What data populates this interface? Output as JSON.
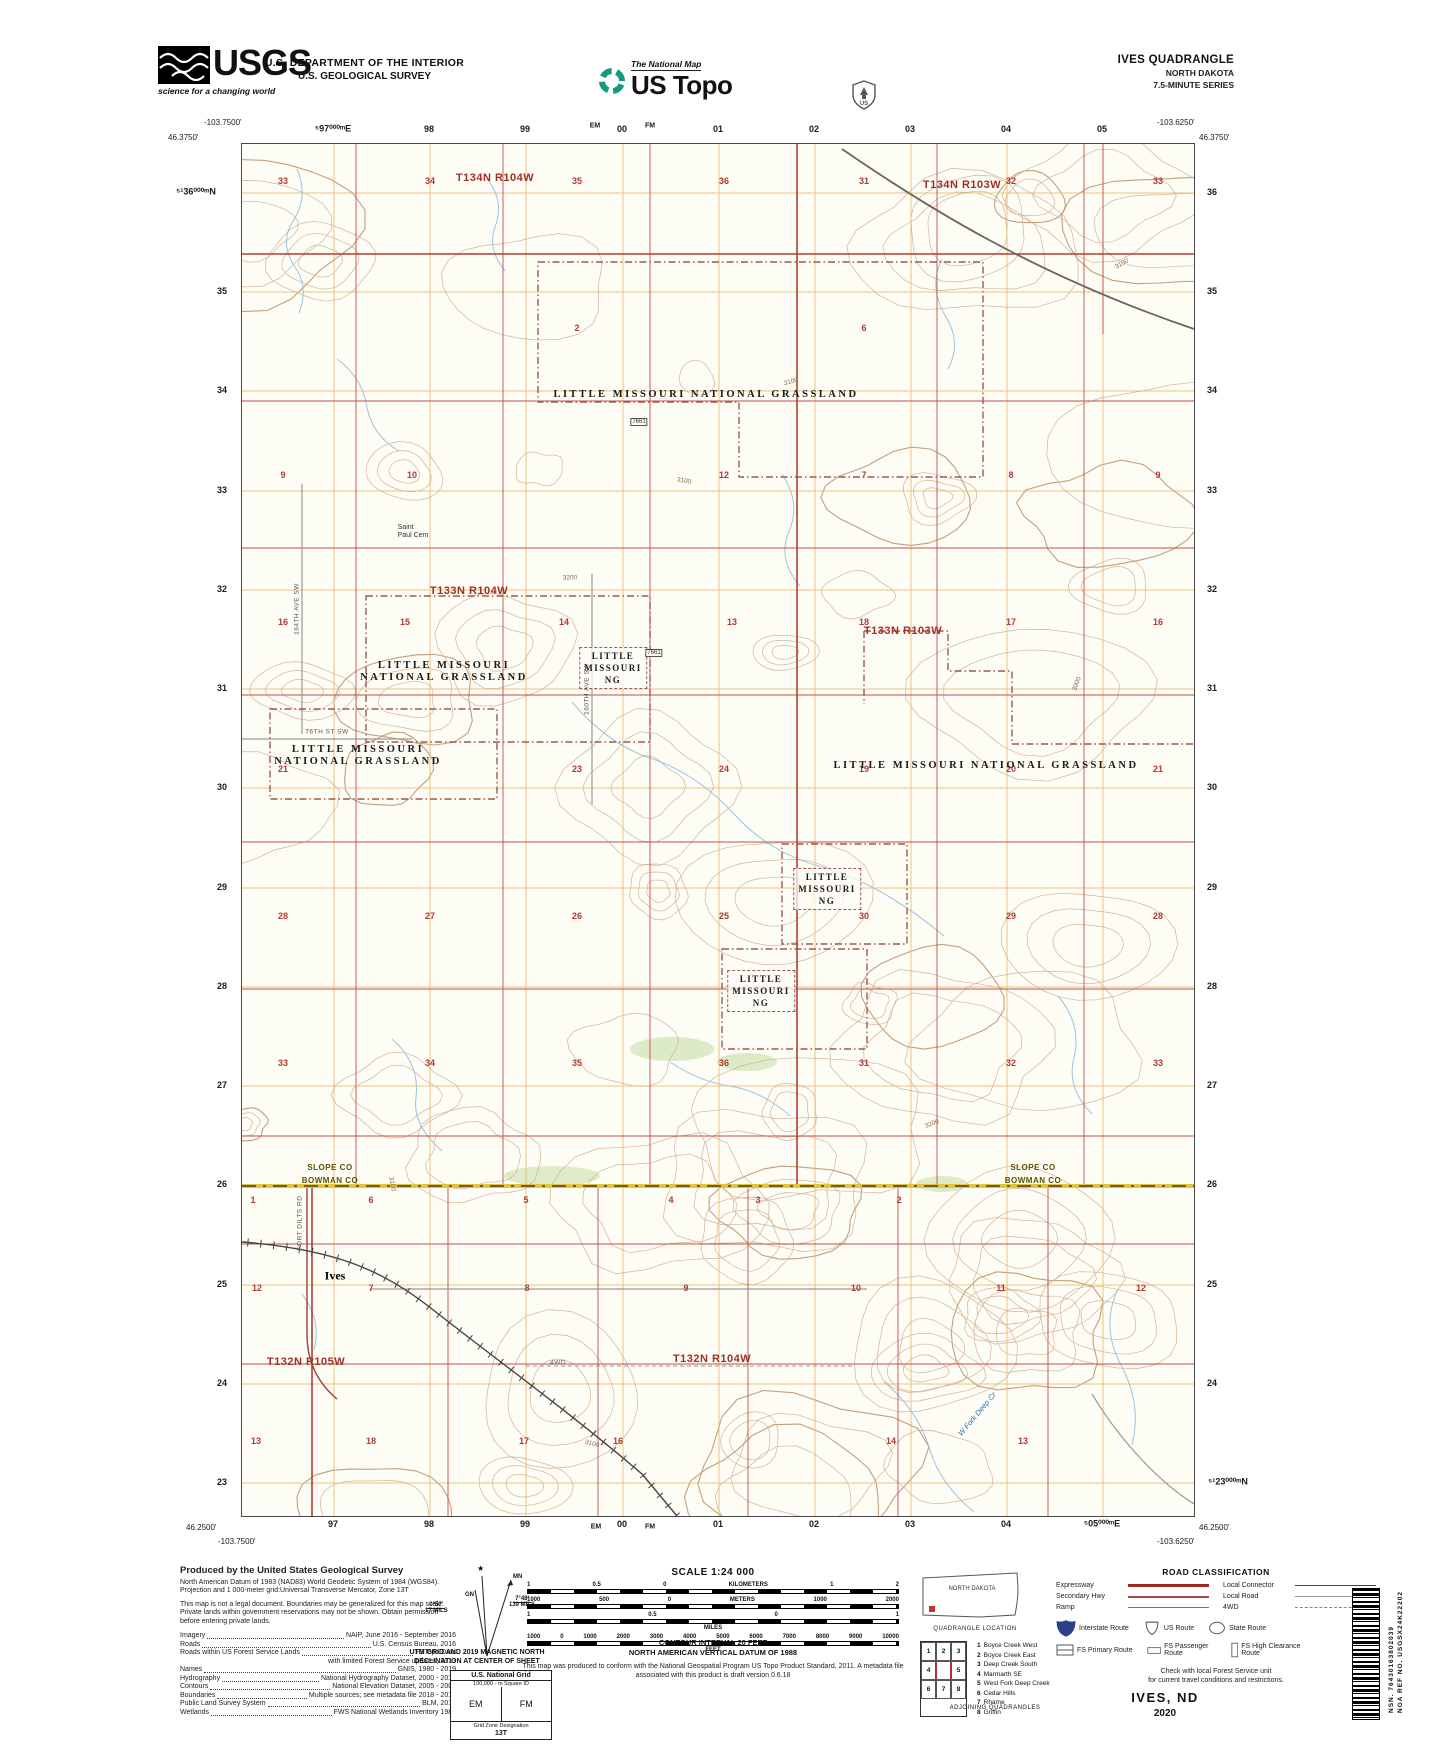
{
  "header": {
    "usgs_word": "USGS",
    "usgs_tagline": "science for a changing world",
    "dept_line1": "U.S. DEPARTMENT OF THE INTERIOR",
    "dept_line2": "U.S. GEOLOGICAL SURVEY",
    "natmap": "The National Map",
    "ustopo": "US Topo",
    "quad_title": "IVES QUADRANGLE",
    "quad_state": "NORTH DAKOTA",
    "quad_series": "7.5-MINUTE SERIES"
  },
  "map": {
    "corners": {
      "tl_lon": "-103.7500'",
      "tl_lat": "46.3750'",
      "tr_lon": "-103.6250'",
      "tr_lat": "46.3750'",
      "bl_lat": "46.2500'",
      "bl_lon": "-103.7500'",
      "br_lat": "46.2500'",
      "br_lon": "-103.6250'"
    },
    "top_labels": [
      {
        "t": "⁵97⁰⁰⁰ᵐE",
        "x": 333,
        "y": 129
      },
      {
        "t": "98",
        "x": 429,
        "y": 129
      },
      {
        "t": "99",
        "x": 525,
        "y": 129
      },
      {
        "t": "EM",
        "x": 595,
        "y": 126,
        "cls": "sm"
      },
      {
        "t": "00",
        "x": 622,
        "y": 129
      },
      {
        "t": "FM",
        "x": 650,
        "y": 126,
        "cls": "sm"
      },
      {
        "t": "01",
        "x": 718,
        "y": 129
      },
      {
        "t": "02",
        "x": 814,
        "y": 129
      },
      {
        "t": "03",
        "x": 910,
        "y": 129
      },
      {
        "t": "04",
        "x": 1006,
        "y": 129
      },
      {
        "t": "05",
        "x": 1102,
        "y": 129
      }
    ],
    "bottom_labels": [
      {
        "t": "97",
        "x": 333,
        "y": 1524
      },
      {
        "t": "98",
        "x": 429,
        "y": 1524
      },
      {
        "t": "99",
        "x": 525,
        "y": 1524
      },
      {
        "t": "EM",
        "x": 596,
        "y": 1527,
        "cls": "sm"
      },
      {
        "t": "00",
        "x": 622,
        "y": 1524
      },
      {
        "t": "FM",
        "x": 650,
        "y": 1527,
        "cls": "sm"
      },
      {
        "t": "01",
        "x": 718,
        "y": 1524
      },
      {
        "t": "02",
        "x": 814,
        "y": 1524
      },
      {
        "t": "03",
        "x": 910,
        "y": 1524
      },
      {
        "t": "04",
        "x": 1006,
        "y": 1524
      },
      {
        "t": "⁵05⁰⁰⁰ᵐE",
        "x": 1102,
        "y": 1524
      }
    ],
    "left_labels": [
      {
        "t": "⁵¹36⁰⁰⁰ᵐN",
        "x": 196,
        "y": 192
      },
      {
        "t": "35",
        "x": 222,
        "y": 291
      },
      {
        "t": "34",
        "x": 222,
        "y": 390
      },
      {
        "t": "33",
        "x": 222,
        "y": 490
      },
      {
        "t": "32",
        "x": 222,
        "y": 589
      },
      {
        "t": "31",
        "x": 222,
        "y": 688
      },
      {
        "t": "30",
        "x": 222,
        "y": 787
      },
      {
        "t": "29",
        "x": 222,
        "y": 887
      },
      {
        "t": "28",
        "x": 222,
        "y": 986
      },
      {
        "t": "27",
        "x": 222,
        "y": 1085
      },
      {
        "t": "26",
        "x": 222,
        "y": 1184
      },
      {
        "t": "25",
        "x": 222,
        "y": 1284
      },
      {
        "t": "24",
        "x": 222,
        "y": 1383
      },
      {
        "t": "23",
        "x": 222,
        "y": 1482
      }
    ],
    "right_labels": [
      {
        "t": "36",
        "x": 1212,
        "y": 192
      },
      {
        "t": "35",
        "x": 1212,
        "y": 291
      },
      {
        "t": "34",
        "x": 1212,
        "y": 390
      },
      {
        "t": "33",
        "x": 1212,
        "y": 490
      },
      {
        "t": "32",
        "x": 1212,
        "y": 589
      },
      {
        "t": "31",
        "x": 1212,
        "y": 688
      },
      {
        "t": "30",
        "x": 1212,
        "y": 787
      },
      {
        "t": "29",
        "x": 1212,
        "y": 887
      },
      {
        "t": "28",
        "x": 1212,
        "y": 986
      },
      {
        "t": "27",
        "x": 1212,
        "y": 1085
      },
      {
        "t": "26",
        "x": 1212,
        "y": 1184
      },
      {
        "t": "25",
        "x": 1212,
        "y": 1284
      },
      {
        "t": "24",
        "x": 1212,
        "y": 1383
      },
      {
        "t": "⁵¹23⁰⁰⁰ᵐN",
        "x": 1228,
        "y": 1482
      }
    ],
    "townships": [
      {
        "t": "T134N R104W",
        "x": 253,
        "y": 34
      },
      {
        "t": "T134N R103W",
        "x": 720,
        "y": 41
      },
      {
        "t": "T133N R104W",
        "x": 227,
        "y": 447
      },
      {
        "t": "T133N R103W",
        "x": 661,
        "y": 487
      },
      {
        "t": "T132N R105W",
        "x": 64,
        "y": 1218
      },
      {
        "t": "T132N R104W",
        "x": 470,
        "y": 1215
      }
    ],
    "sections": [
      {
        "t": "33",
        "x": 41,
        "y": 37
      },
      {
        "t": "34",
        "x": 188,
        "y": 37
      },
      {
        "t": "35",
        "x": 335,
        "y": 37
      },
      {
        "t": "36",
        "x": 482,
        "y": 37
      },
      {
        "t": "31",
        "x": 622,
        "y": 37
      },
      {
        "t": "32",
        "x": 769,
        "y": 37
      },
      {
        "t": "33",
        "x": 916,
        "y": 37
      },
      {
        "t": "2",
        "x": 335,
        "y": 184
      },
      {
        "t": "6",
        "x": 622,
        "y": 184
      },
      {
        "t": "9",
        "x": 41,
        "y": 331
      },
      {
        "t": "10",
        "x": 170,
        "y": 331
      },
      {
        "t": "12",
        "x": 482,
        "y": 331
      },
      {
        "t": "7",
        "x": 622,
        "y": 331
      },
      {
        "t": "8",
        "x": 769,
        "y": 331
      },
      {
        "t": "9",
        "x": 916,
        "y": 331
      },
      {
        "t": "16",
        "x": 41,
        "y": 478
      },
      {
        "t": "15",
        "x": 163,
        "y": 478
      },
      {
        "t": "14",
        "x": 322,
        "y": 478
      },
      {
        "t": "13",
        "x": 490,
        "y": 478
      },
      {
        "t": "18",
        "x": 622,
        "y": 478
      },
      {
        "t": "17",
        "x": 769,
        "y": 478
      },
      {
        "t": "16",
        "x": 916,
        "y": 478
      },
      {
        "t": "21",
        "x": 41,
        "y": 625
      },
      {
        "t": "23",
        "x": 335,
        "y": 625
      },
      {
        "t": "24",
        "x": 482,
        "y": 625
      },
      {
        "t": "19",
        "x": 622,
        "y": 625
      },
      {
        "t": "20",
        "x": 769,
        "y": 625
      },
      {
        "t": "21",
        "x": 916,
        "y": 625
      },
      {
        "t": "28",
        "x": 41,
        "y": 772
      },
      {
        "t": "27",
        "x": 188,
        "y": 772
      },
      {
        "t": "26",
        "x": 335,
        "y": 772
      },
      {
        "t": "25",
        "x": 482,
        "y": 772
      },
      {
        "t": "30",
        "x": 622,
        "y": 772
      },
      {
        "t": "29",
        "x": 769,
        "y": 772
      },
      {
        "t": "28",
        "x": 916,
        "y": 772
      },
      {
        "t": "33",
        "x": 41,
        "y": 919
      },
      {
        "t": "34",
        "x": 188,
        "y": 919
      },
      {
        "t": "35",
        "x": 335,
        "y": 919
      },
      {
        "t": "36",
        "x": 482,
        "y": 919
      },
      {
        "t": "31",
        "x": 622,
        "y": 919
      },
      {
        "t": "32",
        "x": 769,
        "y": 919
      },
      {
        "t": "33",
        "x": 916,
        "y": 919
      },
      {
        "t": "1",
        "x": 11,
        "y": 1056
      },
      {
        "t": "6",
        "x": 129,
        "y": 1056
      },
      {
        "t": "5",
        "x": 284,
        "y": 1056
      },
      {
        "t": "4",
        "x": 429,
        "y": 1056
      },
      {
        "t": "3",
        "x": 516,
        "y": 1056
      },
      {
        "t": "2",
        "x": 657,
        "y": 1056
      },
      {
        "t": "12",
        "x": 15,
        "y": 1144
      },
      {
        "t": "7",
        "x": 129,
        "y": 1144
      },
      {
        "t": "8",
        "x": 285,
        "y": 1144
      },
      {
        "t": "9",
        "x": 444,
        "y": 1144
      },
      {
        "t": "10",
        "x": 614,
        "y": 1144
      },
      {
        "t": "11",
        "x": 759,
        "y": 1144
      },
      {
        "t": "12",
        "x": 899,
        "y": 1144
      },
      {
        "t": "13",
        "x": 14,
        "y": 1297
      },
      {
        "t": "18",
        "x": 129,
        "y": 1297
      },
      {
        "t": "17",
        "x": 282,
        "y": 1297
      },
      {
        "t": "16",
        "x": 376,
        "y": 1297
      },
      {
        "t": "14",
        "x": 649,
        "y": 1297
      },
      {
        "t": "13",
        "x": 781,
        "y": 1297
      }
    ],
    "grassland": [
      {
        "lines": [
          "LITTLE MISSOURI NATIONAL GRASSLAND"
        ],
        "x": 464,
        "y": 251
      },
      {
        "lines": [
          "LITTLE",
          "MISSOURI",
          "NG"
        ],
        "x": 371,
        "y": 524,
        "cls": "ng-box"
      },
      {
        "lines": [
          "LITTLE MISSOURI",
          "NATIONAL GRASSLAND"
        ],
        "x": 202,
        "y": 528,
        "cls": "multi"
      },
      {
        "lines": [
          "LITTLE MISSOURI",
          "NATIONAL GRASSLAND"
        ],
        "x": 116,
        "y": 612,
        "cls": "multi"
      },
      {
        "lines": [
          "LITTLE MISSOURI NATIONAL GRASSLAND"
        ],
        "x": 744,
        "y": 622
      },
      {
        "lines": [
          "LITTLE",
          "MISSOURI",
          "NG"
        ],
        "x": 585,
        "y": 745,
        "cls": "ng-box"
      },
      {
        "lines": [
          "LITTLE",
          "MISSOURI",
          "NG"
        ],
        "x": 519,
        "y": 847,
        "cls": "ng-box"
      }
    ],
    "county_pairs": [
      {
        "top": "SLOPE CO",
        "bottom": "BOWMAN CO",
        "x": 88,
        "y": 1030
      },
      {
        "top": "SLOPE CO",
        "bottom": "BOWMAN CO",
        "x": 791,
        "y": 1030
      }
    ],
    "places": [
      {
        "t": "Ives",
        "x": 93,
        "y": 1132
      }
    ],
    "cemetery": {
      "lines": [
        "Saint",
        "Paul Cem"
      ],
      "x": 171,
      "y": 388
    },
    "road_labels": [
      {
        "t": "FORT DILTS RD",
        "x": 58,
        "y": 1079,
        "rot": -90
      },
      {
        "t": "4WD",
        "x": 316,
        "y": 1219
      },
      {
        "t": "164TH AVE SW",
        "x": 55,
        "y": 465,
        "rot": -90
      },
      {
        "t": "160TH AVE SW",
        "x": 345,
        "y": 545,
        "rot": -90
      },
      {
        "t": "76TH ST SW",
        "x": 85,
        "y": 588
      }
    ],
    "stream_labels": [
      {
        "t": "W Fork Deep Cr",
        "x": 735,
        "y": 1270,
        "rot": -50
      }
    ],
    "elevation_labels": [
      {
        "t": "3100",
        "x": 549,
        "y": 238,
        "rot": -15
      },
      {
        "t": "3100",
        "x": 442,
        "y": 337,
        "rot": 10
      },
      {
        "t": "3200",
        "x": 328,
        "y": 434
      },
      {
        "t": "3200",
        "x": 690,
        "y": 980,
        "rot": -20
      },
      {
        "t": "3100",
        "x": 150,
        "y": 1040,
        "rot": 80
      },
      {
        "t": "3100",
        "x": 880,
        "y": 120,
        "rot": -30
      },
      {
        "t": "3100",
        "x": 350,
        "y": 1300,
        "rot": 15
      },
      {
        "t": "3000",
        "x": 835,
        "y": 540,
        "rot": -70
      }
    ],
    "fs_routes": [
      {
        "t": "7661",
        "x": 397,
        "y": 278
      },
      {
        "t": "7661",
        "x": 412,
        "y": 509
      }
    ]
  },
  "footer": {
    "produced": {
      "title": "Produced by the United States Geological Survey",
      "datum_lines": [
        "North American Datum of 1983 (NAD83)",
        "World Geodetic System of 1984 (WGS84).  Projection and",
        "1 000-meter grid:Universal Transverse Mercator, Zone 13T"
      ],
      "legal_lines": [
        "This map is not a legal document. Boundaries may be",
        "generalized for this map scale. Private lands within government",
        "reservations may not be shown. Obtain permission before",
        "entering private lands."
      ],
      "credits": [
        {
          "k": "Imagery",
          "v": "NAIP, June 2016 - September 2016"
        },
        {
          "k": "Roads",
          "v": "U.S. Census Bureau, 2016"
        },
        {
          "k": "Roads within US Forest Service Lands",
          "v": "FSTopo Data"
        },
        {
          "k": "",
          "v": "with limited Forest Service updates, 2013",
          "cls": "cont"
        },
        {
          "k": "Names",
          "v": "GNIS, 1980 - 2019"
        },
        {
          "k": "Hydrography",
          "v": "National Hydrography Dataset, 2000 - 2019"
        },
        {
          "k": "Contours",
          "v": "National Elevation Dataset, 2005 - 2009"
        },
        {
          "k": "Boundaries",
          "v": "Multiple sources; see metadata file 2018 - 2019"
        },
        {
          "k": "Public Land Survey System",
          "v": "BLM, 2018"
        },
        {
          "k": "Wetlands",
          "v": "FWS National Wetlands Inventory 1983"
        }
      ]
    },
    "declination": {
      "star": "★",
      "mn": "MN",
      "gn": "GN",
      "left_deg": "0°57'",
      "left_mils": "17 MILS",
      "right_deg": "7°48'",
      "right_mils": "139 MILS",
      "caption1": "UTM GRID AND 2019 MAGNETIC NORTH",
      "caption2": "DECLINATION AT CENTER OF SHEET"
    },
    "usng": {
      "title": "U.S. National Grid",
      "sub1": "100,000 - m Square ID",
      "sq_left": "EM",
      "sq_right": "FM",
      "sub2": "Grid Zone Designation",
      "zone": "13T"
    },
    "scale": {
      "title": "SCALE 1:24 000",
      "bars": [
        {
          "labels": [
            "1",
            "0.5",
            "0",
            "KILOMETERS",
            "1",
            "2"
          ],
          "unit": ""
        },
        {
          "labels": [
            "1000",
            "500",
            "0",
            "METERS",
            "1000",
            "2000"
          ],
          "unit": ""
        },
        {
          "labels": [
            "1",
            "0.5",
            "0",
            "1"
          ],
          "unit": "MILES"
        },
        {
          "labels": [
            "1000",
            "0",
            "1000",
            "2000",
            "3000",
            "4000",
            "5000",
            "6000",
            "7000",
            "8000",
            "9000",
            "10000"
          ],
          "unit": "FEET"
        }
      ],
      "contour1": "CONTOUR INTERVAL 20 FEET",
      "contour2": "NORTH AMERICAN VERTICAL DATUM OF 1988",
      "conform": [
        "This map was produced to conform with the",
        "National Geospatial Program US Topo Product Standard, 2011.",
        "A metadata file associated with this product is draft version 0.6.18"
      ]
    },
    "location": {
      "state": "NORTH DAKOTA",
      "caption": "QUADRANGLE LOCATION"
    },
    "adjoining": {
      "grid": [
        "1",
        "2",
        "3",
        "4",
        "",
        "5",
        "6",
        "7",
        "8"
      ],
      "list": [
        {
          "n": "1",
          "name": "Boyce Creek West"
        },
        {
          "n": "2",
          "name": "Boyce Creek East"
        },
        {
          "n": "3",
          "name": "Deep Creek South"
        },
        {
          "n": "4",
          "name": "Marmarth SE"
        },
        {
          "n": "5",
          "name": "West Fork Deep Creek"
        },
        {
          "n": "6",
          "name": "Cedar Hills"
        },
        {
          "n": "7",
          "name": "Rhame"
        },
        {
          "n": "8",
          "name": "Griffin"
        }
      ],
      "caption": "ADJOINING QUADRANGLES"
    },
    "roadclass": {
      "title": "ROAD CLASSIFICATION",
      "rows_left": [
        {
          "label": "Expressway",
          "cls": "expressway"
        },
        {
          "label": "Secondary Hwy",
          "cls": "secondary"
        },
        {
          "label": "Ramp",
          "cls": "ramp"
        }
      ],
      "rows_right": [
        {
          "label": "Local Connector",
          "cls": "connector"
        },
        {
          "label": "Local Road",
          "cls": "local"
        },
        {
          "label": "4WD",
          "cls": "fourwd"
        }
      ],
      "shields": [
        {
          "label": "Interstate Route"
        },
        {
          "label": "US Route"
        },
        {
          "label": "State Route"
        }
      ],
      "fs": [
        {
          "label": "FS Primary Route"
        },
        {
          "label": "FS Passenger Route"
        },
        {
          "label": "FS High Clearance Route"
        }
      ],
      "note1": "Check with local Forest Service unit",
      "note2": "for current travel conditions and restrictions."
    },
    "sheet_name": "IVES,  ND",
    "sheet_year": "2020",
    "barcode": {
      "nsn": "NSN. 76430163802039",
      "ref": "NGA REF NO. USGSX24K22202"
    },
    "accent_red": "#9e2b25",
    "topo_green": "#169a7f",
    "interstate_blue": "#2b3f8c"
  }
}
